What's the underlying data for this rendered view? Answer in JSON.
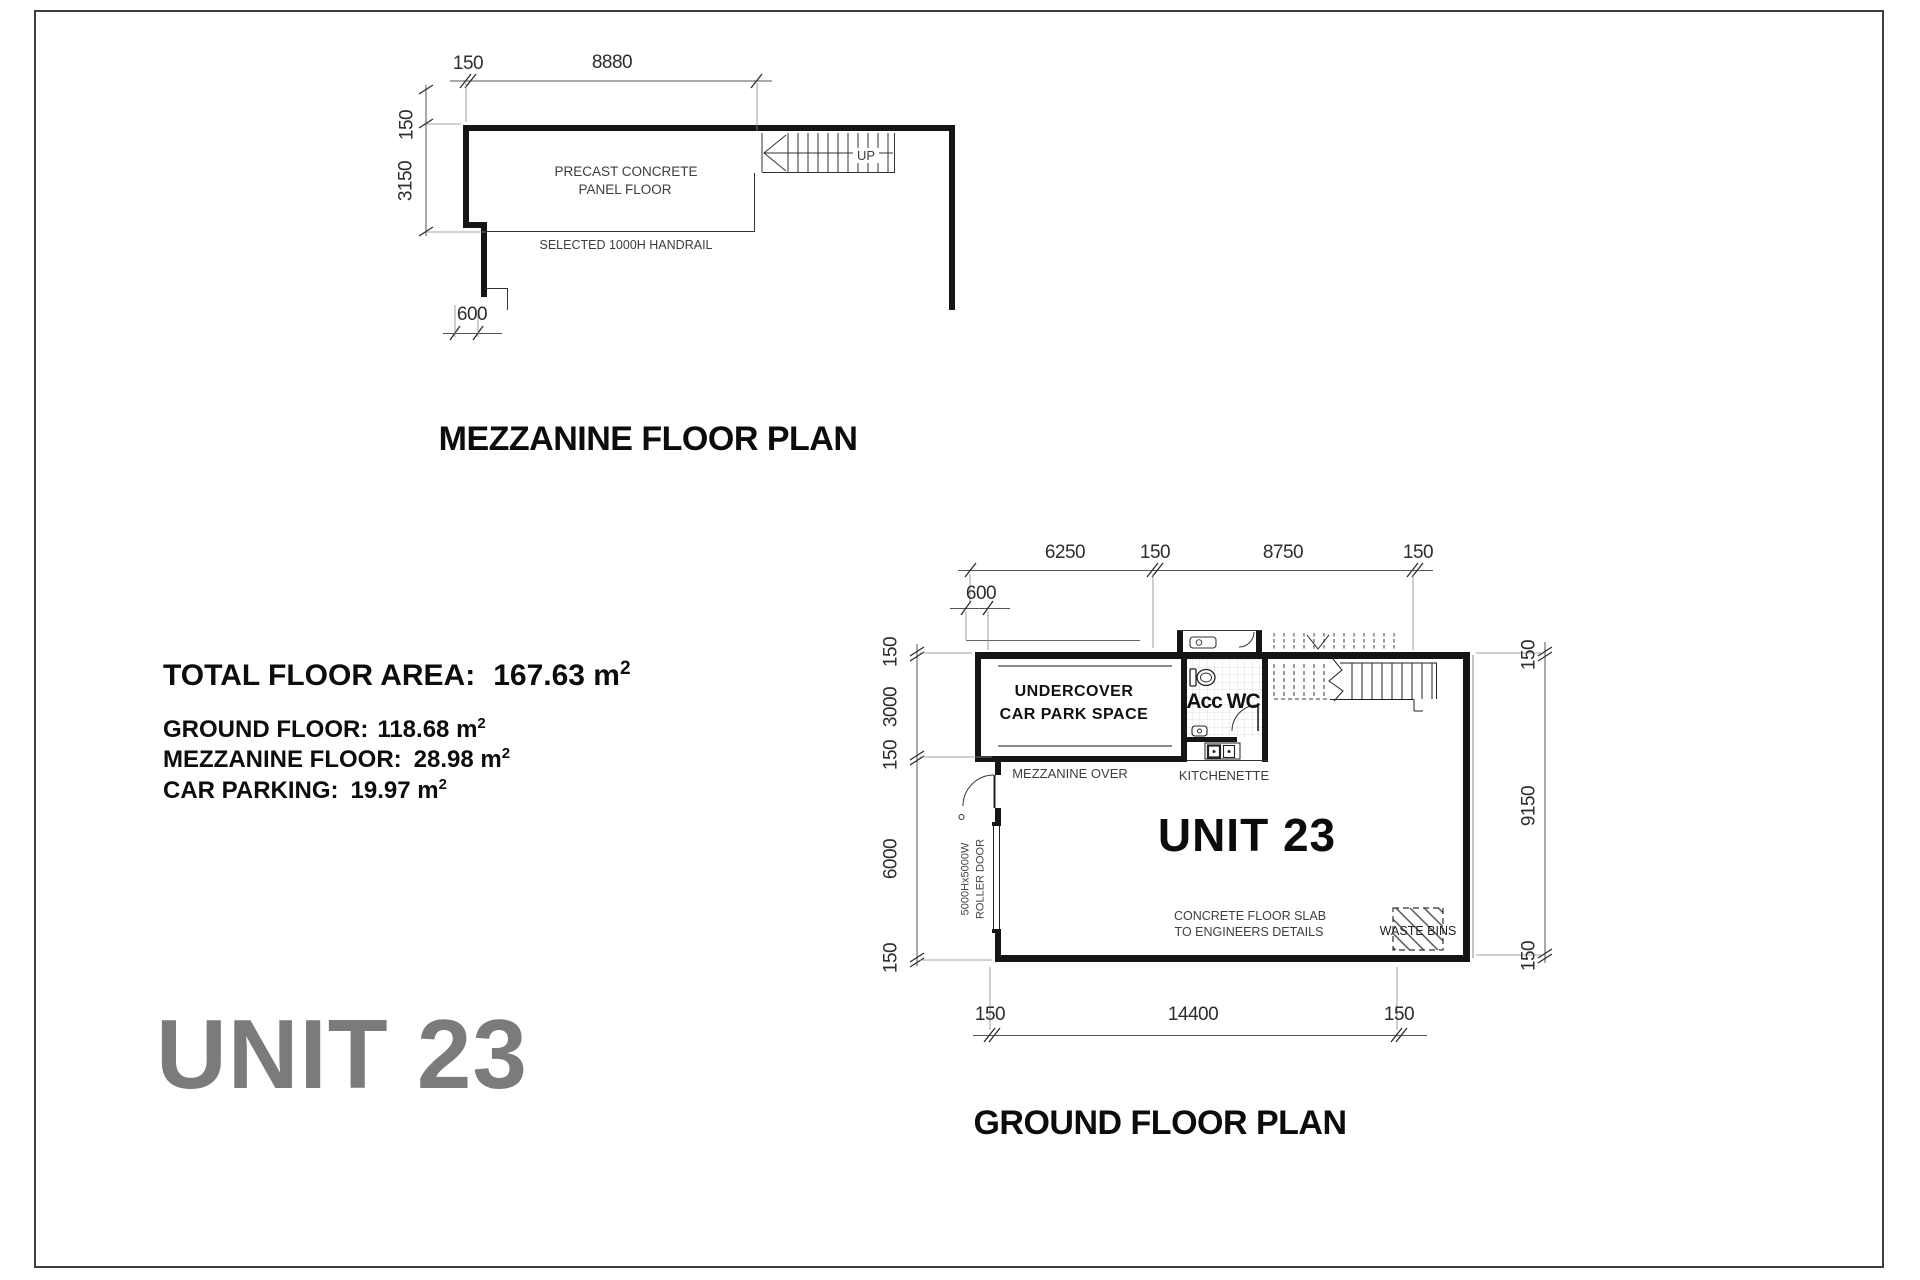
{
  "unit_banner": "UNIT 23",
  "mezzanine": {
    "title": "MEZZANINE FLOOR PLAN",
    "floor_label_1": "PRECAST CONCRETE",
    "floor_label_2": "PANEL FLOOR",
    "handrail_label": "SELECTED 1000H HANDRAIL",
    "up_label": "UP",
    "dim_top_150": "150",
    "dim_top_8880": "8880",
    "dim_left_150": "150",
    "dim_left_3150": "3150",
    "dim_600": "600"
  },
  "areas": {
    "total_label": "TOTAL FLOOR AREA:",
    "total_value": "167.63 m",
    "sup": "2",
    "rows": [
      {
        "label": "GROUND FLOOR:",
        "value": "118.68 m"
      },
      {
        "label": "MEZZANINE FLOOR:",
        "value": "28.98 m"
      },
      {
        "label": "CAR PARKING:",
        "value": "19.97 m"
      }
    ]
  },
  "ground": {
    "title": "GROUND FLOOR PLAN",
    "unit_label": "UNIT 23",
    "carpark_1": "UNDERCOVER",
    "carpark_2": "CAR PARK SPACE",
    "wc_label": "Acc WC",
    "mezz_over": "MEZZANINE OVER",
    "kitchenette": "KITCHENETTE",
    "slab_1": "CONCRETE FLOOR SLAB",
    "slab_2": "TO ENGINEERS DETAILS",
    "waste_bins": "WASTE BINS",
    "roller_1": "5000Hx5000W",
    "roller_2": "ROLLER DOOR",
    "dim_600": "600",
    "dim_top": [
      "6250",
      "150",
      "8750",
      "150"
    ],
    "dim_left": [
      "150",
      "3000",
      "150",
      "6000",
      "150"
    ],
    "dim_right": [
      "150",
      "9150",
      "150"
    ],
    "dim_bottom": [
      "150",
      "14400",
      "150"
    ]
  }
}
